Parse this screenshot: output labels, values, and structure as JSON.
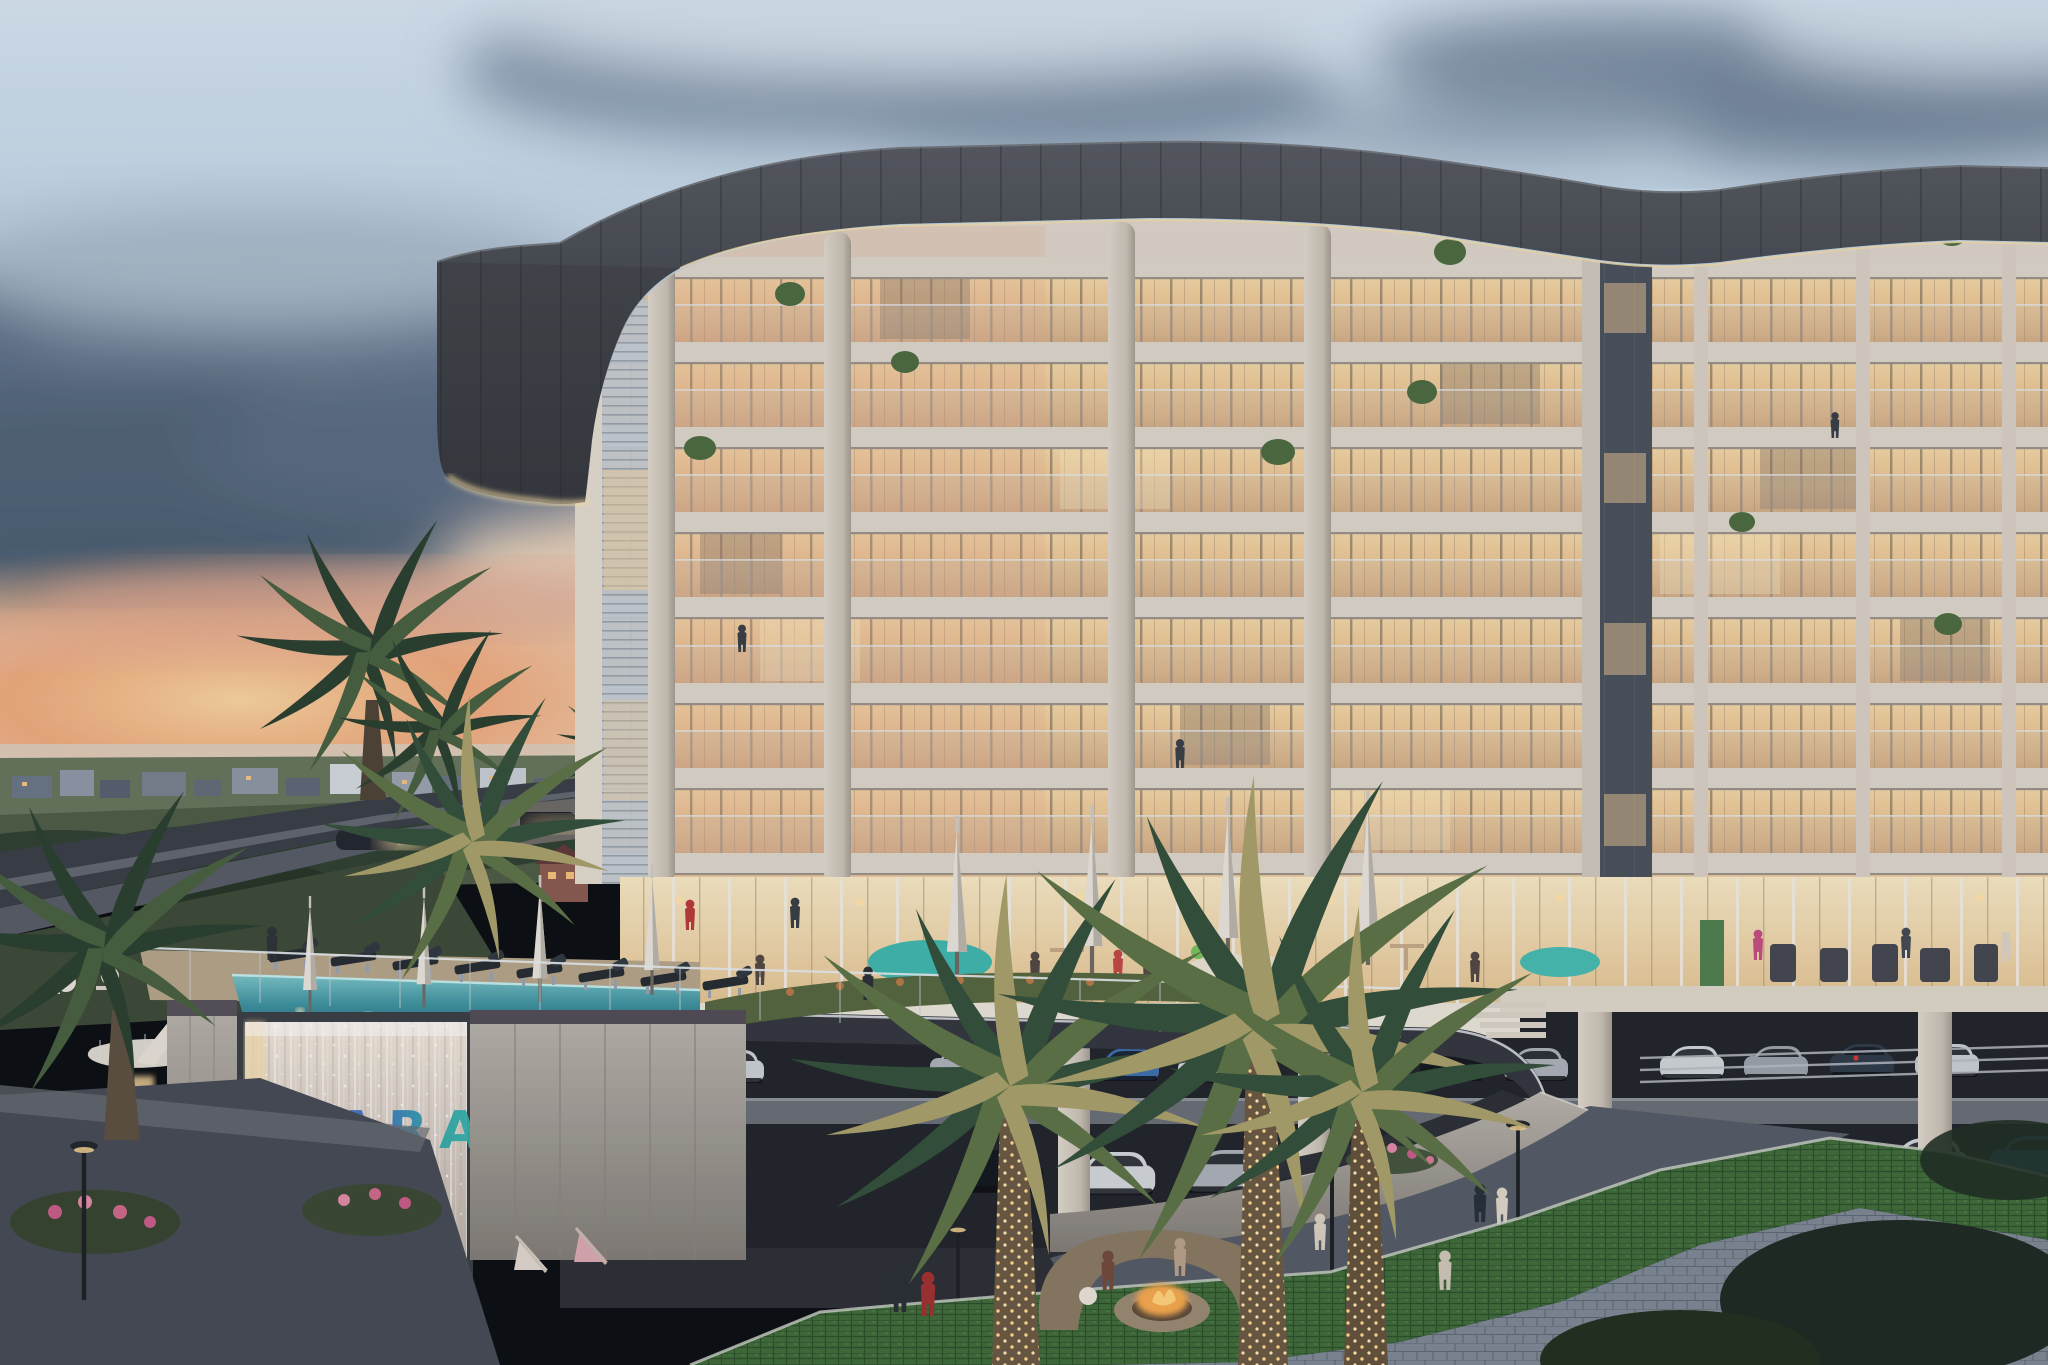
{
  "scene": {
    "description": "dusk architectural rendering of curved condominium tower with amenity deck, infinity pool, waterfall feature wall and parking podium",
    "sign": {
      "text": "TIARA",
      "color_primary": "#3d72c6",
      "color_secondary": "#2fa9a8"
    },
    "palette": {
      "sky_top": "#cfe0ee",
      "sky_mid": "#b7c9dc",
      "sunset": "#ee9f6e",
      "cloud_dark": "#5f7189",
      "roof_fascia": "#3c3f45",
      "facade_concrete": "#d8d0c4",
      "window_glow": "#eec897",
      "pool_water": "#3f93a0",
      "waterfall": "#d8cfc6",
      "palm_lit": "#a8a06a",
      "palm_dark": "#33503a",
      "hedge_green": "#3f6b3a",
      "string_lights": "#ffd98e",
      "fire_glow": "#f6a94e"
    }
  }
}
